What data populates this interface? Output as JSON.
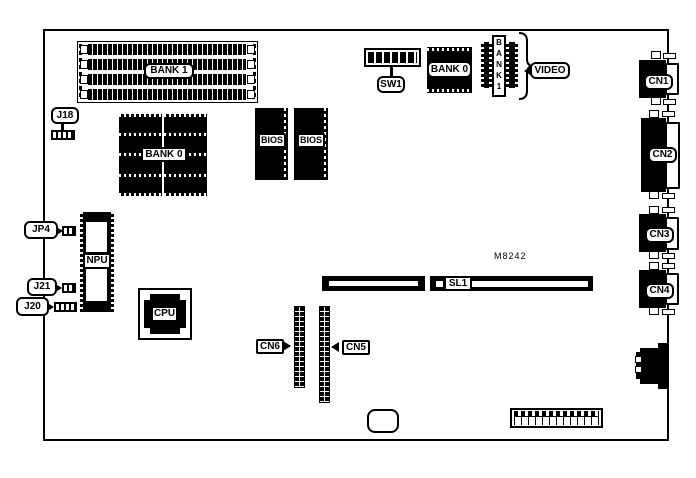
{
  "memory": {
    "bank1": "BANK 1",
    "bank0": "BANK 0"
  },
  "bios": {
    "left": "BIOS",
    "right": "BIOS"
  },
  "video": {
    "bank0": "BANK 0",
    "bank1_vertical": "B\nA\nN\nK\n1",
    "label": "VIDEO"
  },
  "chips": {
    "cpu": "CPU",
    "npu": "NPU",
    "m8242": "M8242"
  },
  "switches": {
    "sw1": "SW1"
  },
  "jumpers": {
    "j18": "J18",
    "jp4": "JP4",
    "j21": "J21",
    "j20": "J20"
  },
  "slots": {
    "sl1": "SL1"
  },
  "connectors": {
    "cn1": "CN1",
    "cn2": "CN2",
    "cn3": "CN3",
    "cn4": "CN4",
    "cn5": "CN5",
    "cn6": "CN6"
  },
  "colors": {
    "line": "#000000",
    "background": "#ffffff"
  }
}
